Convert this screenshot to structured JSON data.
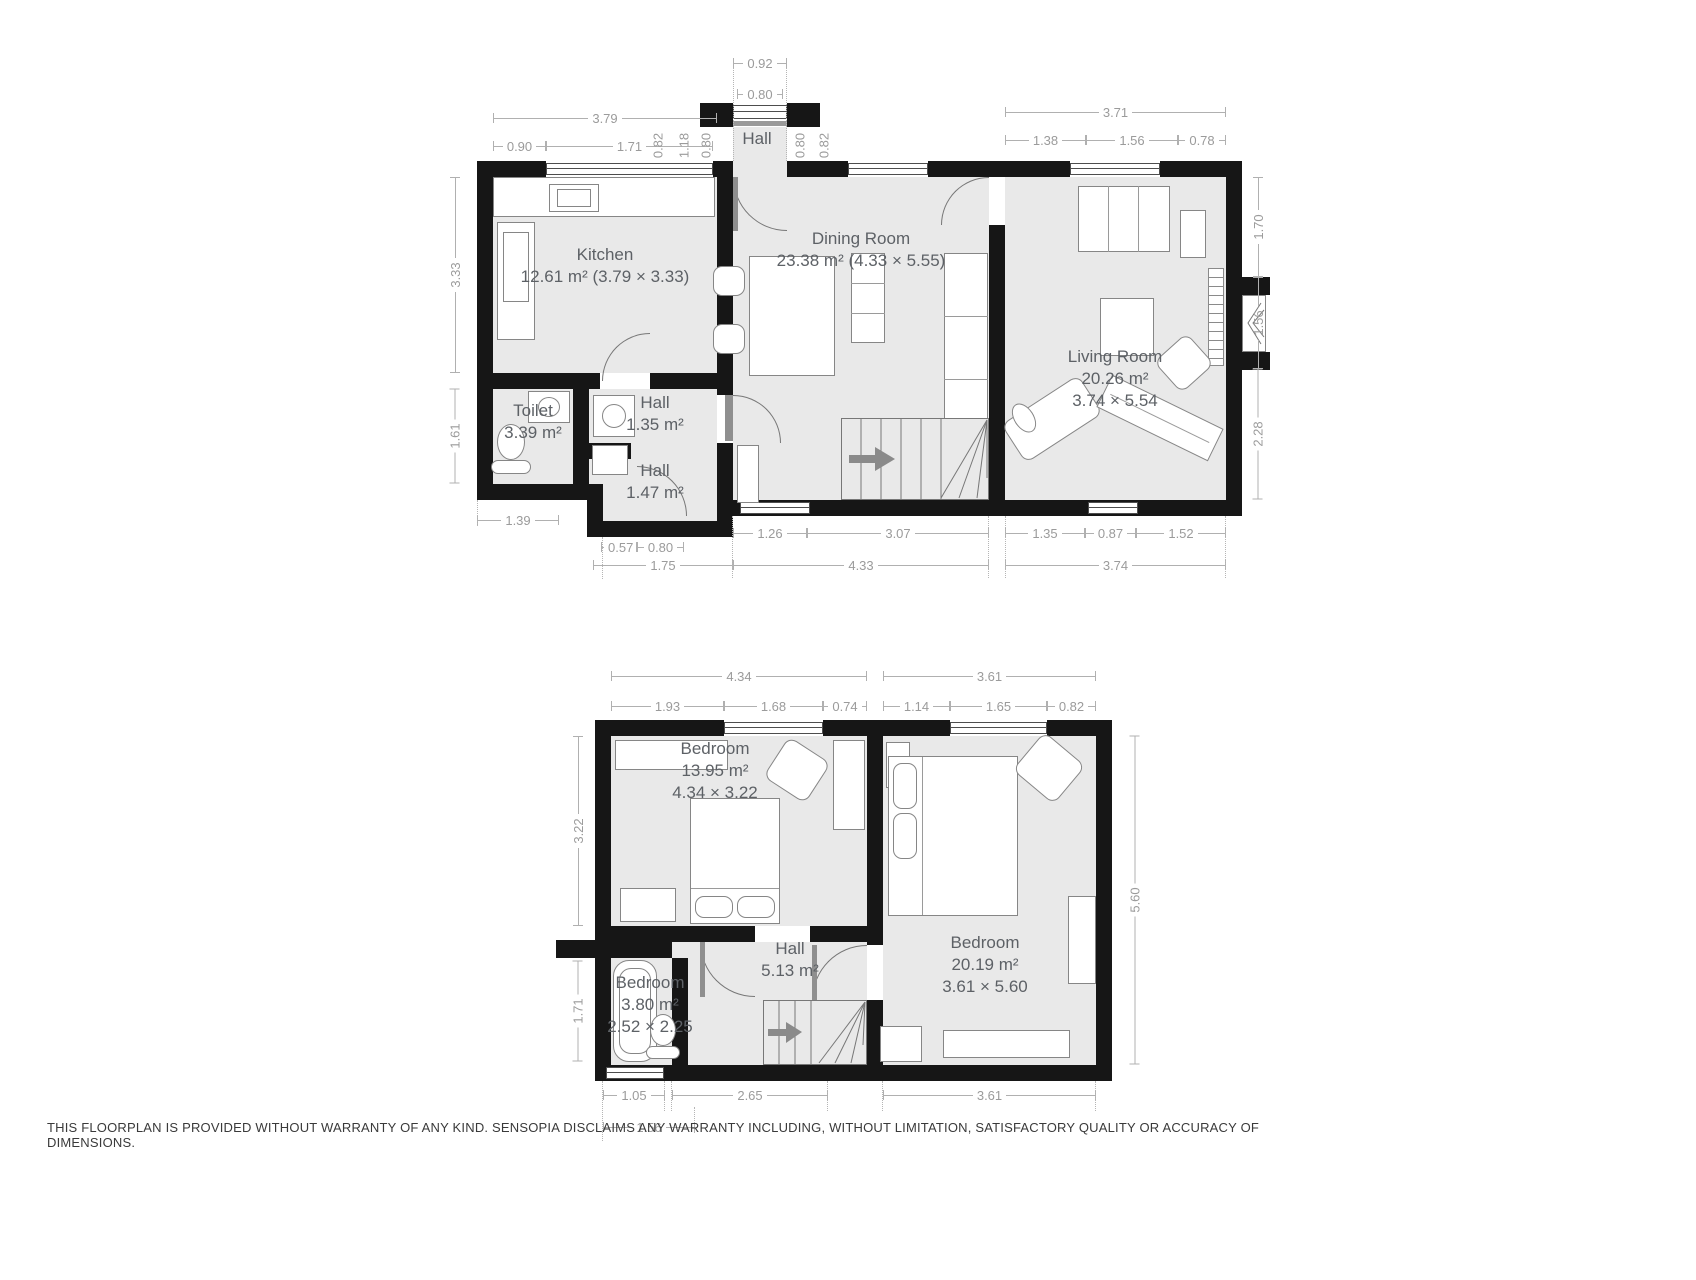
{
  "colors": {
    "wall": "#161616",
    "floor": "#e9e9e9",
    "dim_text": "#9b9b9b",
    "label_text": "#5d6166"
  },
  "disclaimer": "THIS FLOORPLAN IS PROVIDED WITHOUT WARRANTY OF ANY KIND. SENSOPIA DISCLAIMS ANY WARRANTY INCLUDING, WITHOUT LIMITATION, SATISFACTORY QUALITY OR ACCURACY OF DIMENSIONS.",
  "ground": {
    "rooms": {
      "kitchen": {
        "l1": "Kitchen",
        "l2": "12.61 m² (3.79 × 3.33)"
      },
      "hall_entry": {
        "l1": "Hall"
      },
      "dining": {
        "l1": "Dining Room",
        "l2": "23.38 m² (4.33 × 5.55)"
      },
      "living": {
        "l1": "Living Room",
        "l2": "20.26 m²",
        "l3": "3.74 × 5.54"
      },
      "toilet": {
        "l1": "Toilet",
        "l2": "3.39 m²"
      },
      "hall1": {
        "l1": "Hall",
        "l2": "1.35 m²"
      },
      "hall2": {
        "l1": "Hall",
        "l2": "1.47 m²"
      }
    },
    "dims": {
      "porch_outer": "0.92",
      "porch_inner": "0.80",
      "kitchen_total": "3.79",
      "k1": "0.90",
      "k2": "1.71",
      "k3": "0.82",
      "k4": "1.18",
      "k5": "0.80",
      "p1": "0.80",
      "p2": "0.82",
      "living_total": "3.71",
      "lv1": "1.38",
      "lv2": "1.56",
      "lv3": "0.78",
      "left1": "3.33",
      "left2": "1.61",
      "right1": "1.70",
      "right2": "1.56",
      "right3": "2.28",
      "toilet_w": "1.39",
      "b1": "0.57",
      "b2": "0.80",
      "b3": "1.26",
      "b4": "3.07",
      "b5": "1.35",
      "b6": "0.87",
      "b7": "1.52",
      "bt1": "1.75",
      "bt2": "4.33",
      "bt3": "3.74"
    }
  },
  "upper": {
    "rooms": {
      "bed1": {
        "l1": "Bedroom",
        "l2": "13.95 m²",
        "l3": "4.34 × 3.22"
      },
      "bed2": {
        "l1": "Bedroom",
        "l2": "20.19 m²",
        "l3": "3.61 × 5.60"
      },
      "bath": {
        "l1": "Bedroom",
        "l2": "3.80 m²",
        "l3": "2.52 × 2.25"
      },
      "hall": {
        "l1": "Hall",
        "l2": "5.13 m²"
      }
    },
    "dims": {
      "t1": "4.34",
      "u1": "1.93",
      "u2": "1.68",
      "u3": "0.74",
      "t2": "3.61",
      "u4": "1.14",
      "u5": "1.65",
      "u6": "0.82",
      "left1": "3.22",
      "left2": "1.71",
      "right1": "5.60",
      "d1": "1.05",
      "d2": "2.65",
      "d3": "3.61",
      "d4": "1.56"
    }
  }
}
